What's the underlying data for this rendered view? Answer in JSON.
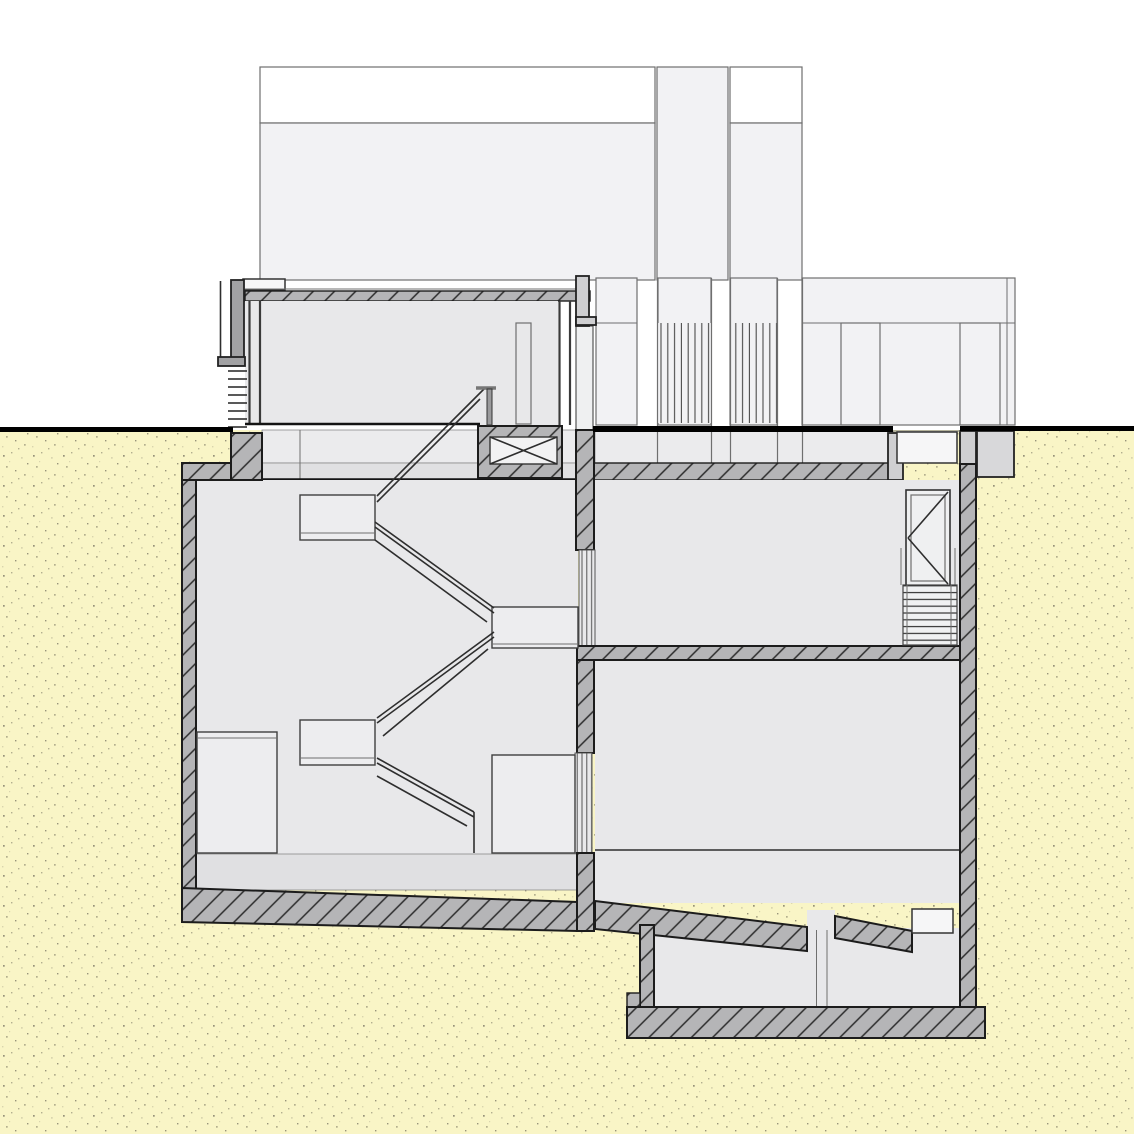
{
  "drawing": {
    "kind": "architectural cross-section",
    "subject": "building section: above-ground storeys with louvered facade, glazed entry level, dog-leg basement stair, two basement rooms and a deep lower cellar, surrounded by stippled soil"
  },
  "colors": {
    "background": "#ffffff",
    "soil": "#f9f5c6",
    "soil_speckle_dark": "#97937a",
    "soil_speckle_mid": "#b3af8e",
    "soil_speckle_light": "#d9d5ae",
    "wall_fill": "#b5b5b7",
    "wall_hatch_line": "#2c2c2c",
    "outline": "#1c1c1c",
    "building_fill": "#f2f2f4",
    "building_stroke": "#6f6f6f",
    "room_fill": "#e8e8ea",
    "slab_band_light": "#ebebed",
    "slab_band_dark": "#e0e0e2",
    "cap_fill": "#cfcfd1",
    "parapet_fill": "#a2a2a4",
    "furniture_fill": "#ededef",
    "porch_fill": "#d8d8da",
    "ground_line": "#000000",
    "detail_line": "#2e2e2e",
    "louver_dark": "#3a3a3a",
    "louver_mid": "#8a8a8a"
  }
}
